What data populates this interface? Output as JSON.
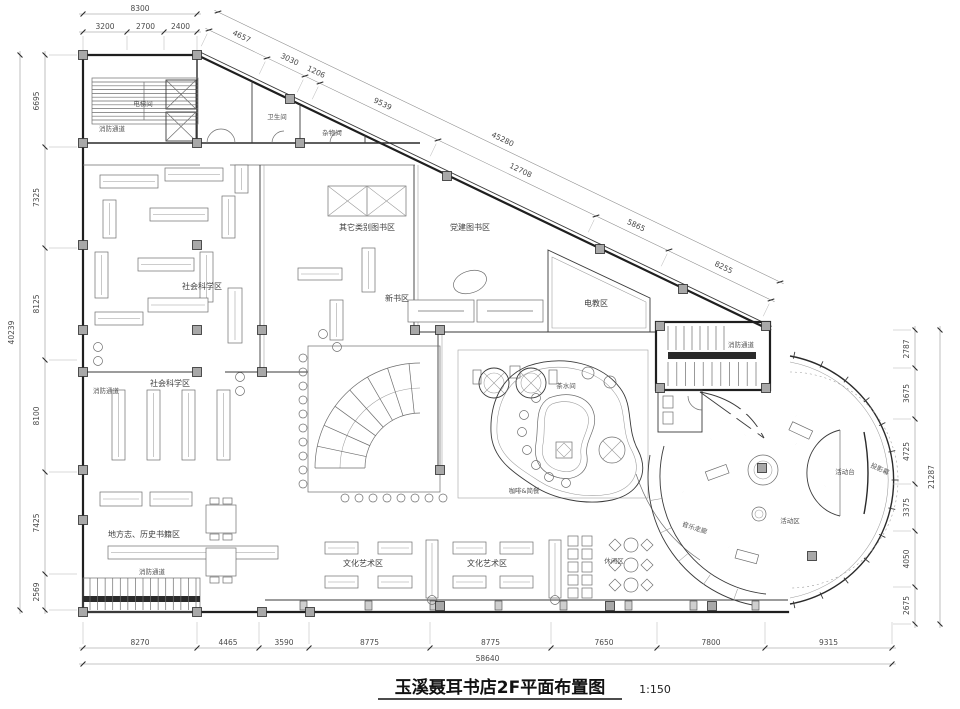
{
  "title": {
    "main": "玉溪聂耳书店2F平面布置图",
    "scale": "1:150"
  },
  "dimensions": {
    "top": {
      "total": "8300",
      "segments": [
        "3200",
        "2700",
        "2400"
      ]
    },
    "diagonal": {
      "total": "45280",
      "segments": [
        "4657",
        "3030",
        "1206",
        "9539",
        "12708",
        "5865",
        "8255"
      ]
    },
    "left": {
      "total": "40239",
      "segments": [
        "6695",
        "7325",
        "8125",
        "8100",
        "7425",
        "2569"
      ]
    },
    "right": {
      "total": "21287",
      "segments": [
        "2787",
        "3675",
        "4725",
        "3375",
        "4050",
        "2675"
      ]
    },
    "bottom": {
      "total": "58640",
      "segments": [
        "8270",
        "4465",
        "3590",
        "8775",
        "8775",
        "7650",
        "7800",
        "9315"
      ]
    }
  },
  "rooms": {
    "elevator": "电梯间",
    "fire_escape": "消防通道",
    "toilet": "卫生间",
    "storage": "杂物间",
    "other_books": "其它类别图书区",
    "party_books": "党建图书区",
    "social_science": "社会科学区",
    "new_books": "新书区",
    "e_learning": "电教区",
    "pantry": "茶水间",
    "cafe": "咖啡&简餐",
    "local_history": "地方志、历史书籍区",
    "culture_art": "文化艺术区",
    "leisure": "休闲区",
    "music_corridor": "音乐走廊",
    "activity_area": "活动区",
    "activity_stage": "活动台",
    "projection_screen": "投影幕"
  },
  "colors": {
    "wall": "#1f1f1f",
    "column": "#a8a8a8",
    "dim_text": "#4a4a4a"
  }
}
